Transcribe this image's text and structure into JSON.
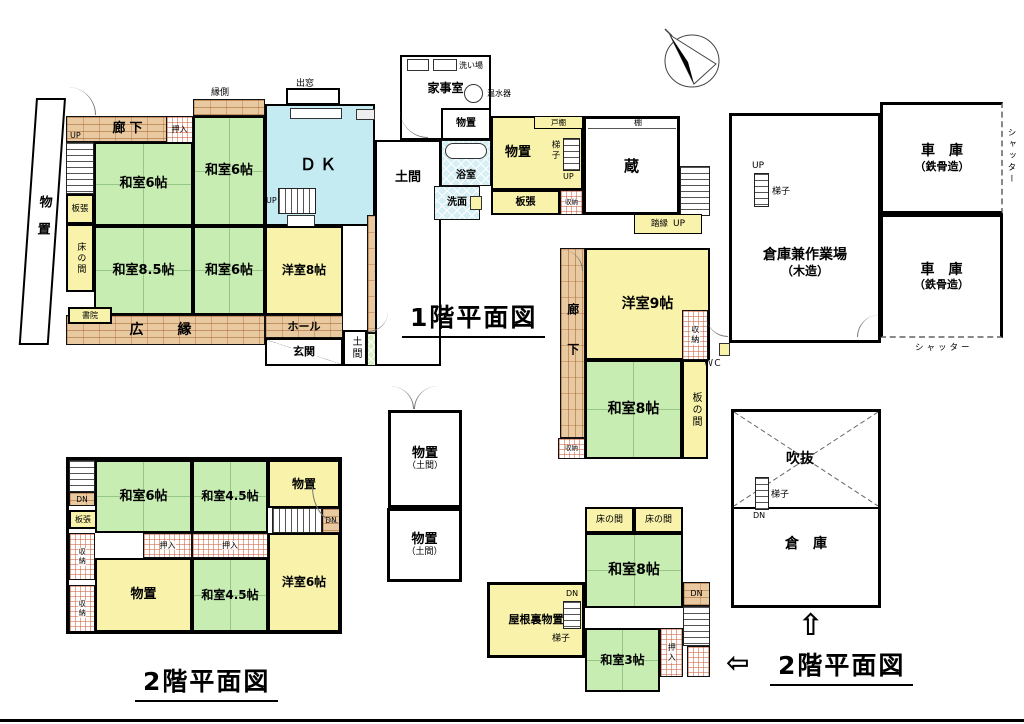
{
  "t": {
    "f1": "1階平面図",
    "f2": "2階平面図",
    "arrow_up": "⇧",
    "arrow_left": "⇦"
  },
  "f1": {
    "monooki_w": "物置",
    "up1": "UP",
    "rouka_n": "廊下",
    "oshiire": "押入",
    "engawa": "縁側",
    "w6a": "和室6帖",
    "w6b": "和室6帖",
    "itabari1": "板張",
    "tokonoma": "床の間",
    "w85": "和室8.5帖",
    "w6c": "和室6帖",
    "shoin": "書院",
    "hiroen": "広　縁",
    "demado": "出窓",
    "dk": "ＤＫ",
    "up2": "UP",
    "mantle": "マントルピース",
    "y8": "洋室8帖",
    "rouka_c": "廊下",
    "hall": "ホール",
    "genkan": "玄関",
    "doma_s": "土間",
    "wc1": "WC",
    "doma": "土間",
    "kaji": "家事室",
    "araiba": "洗い場",
    "onsui": "温水器",
    "monooki_n": "物置",
    "yoku": "浴室",
    "senmen": "洗面",
    "monooki_e": "物置",
    "todana": "戸棚",
    "hashigo1": "梯子",
    "up3": "UP",
    "itabari2": "板張",
    "shuno1": "収納",
    "kura": "蔵",
    "tana": "棚",
    "fumien": "踏縁",
    "up4": "UP",
    "rouka_e": "廊下",
    "shuno2": "収納",
    "y9": "洋室9帖",
    "shuno3": "収納",
    "w8": "和室8帖",
    "itanoma": "板の間",
    "wc2": "ＷＣ",
    "shuno4": "収納",
    "wc3": "ＷＣ"
  },
  "out": {
    "ws1": "倉庫兼作業場",
    "ws2": "（木造）",
    "up": "UP",
    "hashigo": "梯子",
    "g1a": "車　庫",
    "g1b": "（鉄骨造）",
    "g2a": "車　庫",
    "g2b": "（鉄骨造）",
    "shutter_e": "シャッター",
    "shutter_s": "シャッター"
  },
  "ds": {
    "m1a": "物置",
    "m1b": "（土間）",
    "m2a": "物置",
    "m2b": "（土間）"
  },
  "f2r": {
    "fuki": "吹抜",
    "hashigo": "梯子",
    "dn": "DN",
    "souko": "倉　庫"
  },
  "f2m": {
    "toko1": "床の間",
    "toko2": "床の間",
    "w8": "和室8帖",
    "yane": "屋根裏物置",
    "dn1": "DN",
    "hashigo": "梯子",
    "w3": "和室3帖",
    "oshiire": "押入",
    "dn2": "DN"
  },
  "f2l": {
    "dn1": "DN",
    "itabari": "板張",
    "shuno1": "収納",
    "shuno2": "収納",
    "w6": "和室6帖",
    "w45a": "和室4.5帖",
    "monooki_a": "物置",
    "dn2": "DN",
    "oshi1": "押入",
    "oshi2": "押入",
    "monooki_b": "物置",
    "w45b": "和室4.5帖",
    "y6": "洋室6帖"
  }
}
